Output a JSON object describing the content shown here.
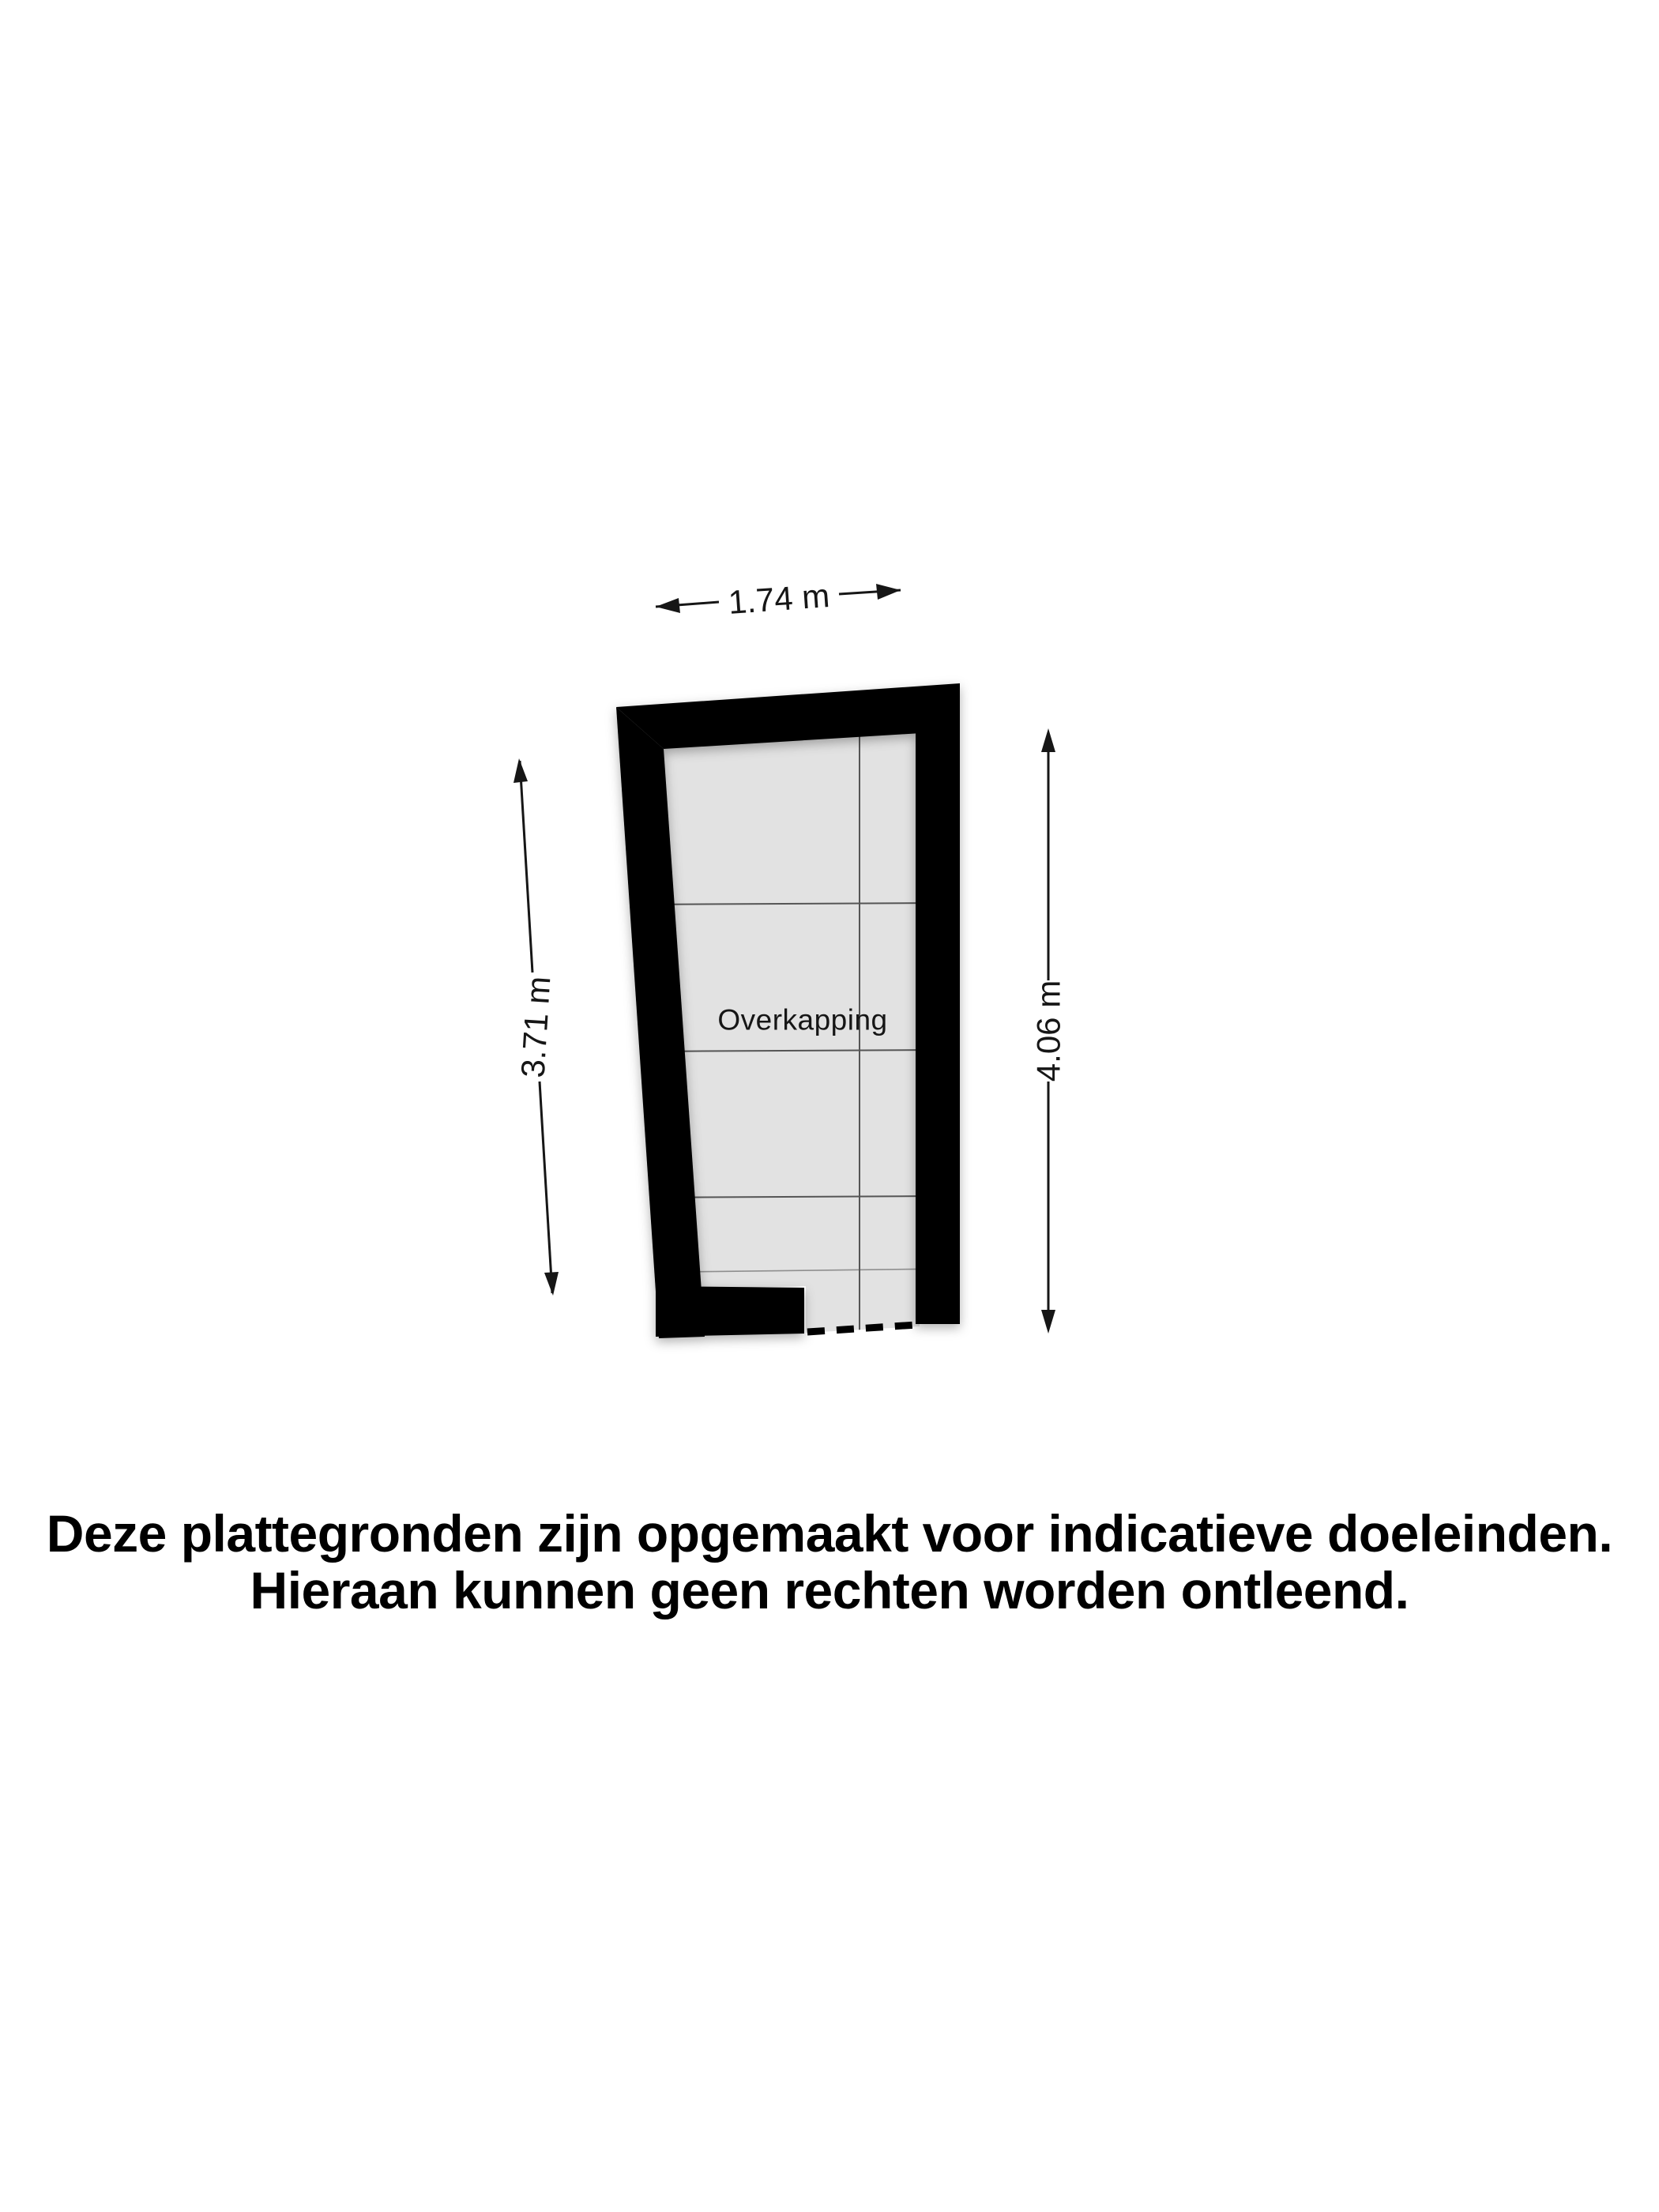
{
  "plan": {
    "room_label": "Overkapping",
    "dimensions": {
      "top_width": "1.74 m",
      "left_height": "3.71 m",
      "right_height": "4.06 m"
    }
  },
  "disclaimer": {
    "line1": "Deze plattegronden zijn opgemaakt voor indicatieve doeleinden.",
    "line2": "Hieraan kunnen geen rechten worden ontleend."
  },
  "colors": {
    "background": "#ffffff",
    "wall": "#000000",
    "floor": "#e2e2e2",
    "grid_line": "#555555",
    "dimension_text": "#161616",
    "disclaimer_text": "#000000"
  }
}
